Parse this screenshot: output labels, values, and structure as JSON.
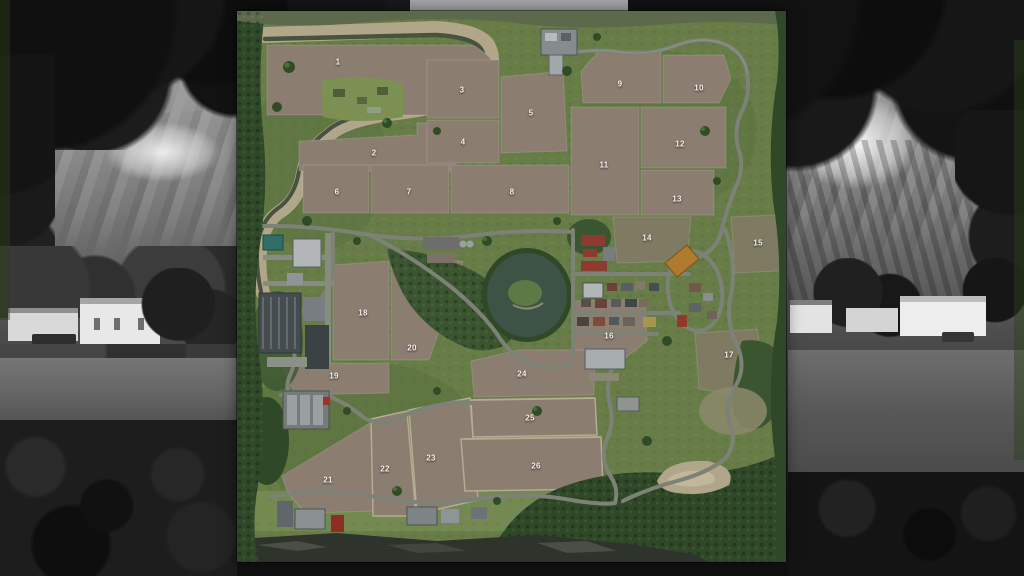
{
  "map": {
    "field_labels": [
      {
        "n": "1",
        "x": 101,
        "y": 51
      },
      {
        "n": "2",
        "x": 137,
        "y": 142
      },
      {
        "n": "3",
        "x": 225,
        "y": 79
      },
      {
        "n": "4",
        "x": 226,
        "y": 131
      },
      {
        "n": "5",
        "x": 294,
        "y": 102
      },
      {
        "n": "6",
        "x": 100,
        "y": 181
      },
      {
        "n": "7",
        "x": 172,
        "y": 181
      },
      {
        "n": "8",
        "x": 275,
        "y": 181
      },
      {
        "n": "9",
        "x": 383,
        "y": 73
      },
      {
        "n": "10",
        "x": 462,
        "y": 77
      },
      {
        "n": "11",
        "x": 367,
        "y": 154
      },
      {
        "n": "12",
        "x": 443,
        "y": 133
      },
      {
        "n": "13",
        "x": 440,
        "y": 188
      },
      {
        "n": "14",
        "x": 410,
        "y": 227
      },
      {
        "n": "15",
        "x": 521,
        "y": 232
      },
      {
        "n": "16",
        "x": 372,
        "y": 325
      },
      {
        "n": "17",
        "x": 492,
        "y": 344
      },
      {
        "n": "18",
        "x": 126,
        "y": 302
      },
      {
        "n": "19",
        "x": 97,
        "y": 365
      },
      {
        "n": "20",
        "x": 175,
        "y": 337
      },
      {
        "n": "21",
        "x": 91,
        "y": 469
      },
      {
        "n": "22",
        "x": 148,
        "y": 458
      },
      {
        "n": "23",
        "x": 194,
        "y": 447
      },
      {
        "n": "24",
        "x": 285,
        "y": 363
      },
      {
        "n": "25",
        "x": 293,
        "y": 407
      },
      {
        "n": "26",
        "x": 299,
        "y": 455
      }
    ]
  },
  "colors": {
    "terrain_grass": "#687c48",
    "terrain_grass_dark": "#55703c",
    "forest": "#3a5530",
    "forest_dark": "#2f4828",
    "field_brown": "#8c7d71",
    "field_olive": "#7f7b63",
    "field_margin": "#b5ac94",
    "sand": "#b2a68a",
    "water": "#3d5345",
    "river_water": "#47523f",
    "road": "#7c8276",
    "road_light": "#9aa08f",
    "roof_red": "#8e3a2f",
    "barn_orange": "#b07a2e",
    "building_light": "#b2b6b8",
    "building_gray": "#8f9597",
    "building_dark": "#454c50",
    "building_teal": "#2f6f68",
    "cliff": "#2e332b",
    "label_text": "#f2eee7"
  }
}
